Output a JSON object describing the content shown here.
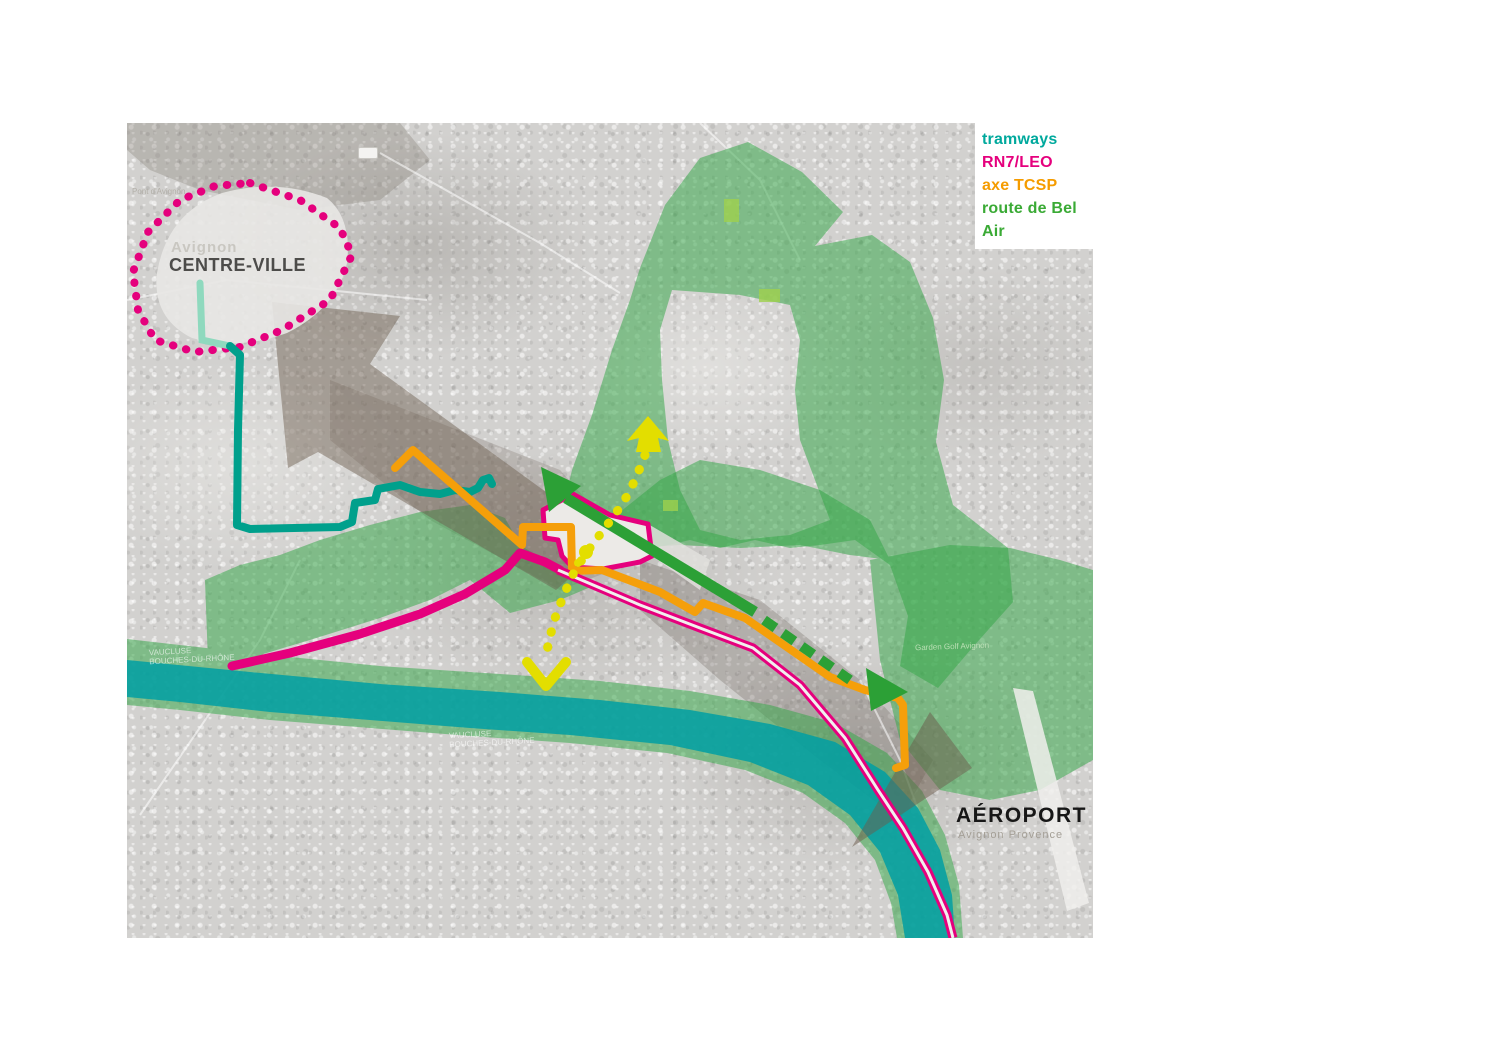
{
  "legend": {
    "items": [
      {
        "label": "tramways",
        "color": "#00A99D"
      },
      {
        "label": "RN7/LEO",
        "color": "#E5007D"
      },
      {
        "label": "axe TCSP",
        "color": "#F59C00"
      },
      {
        "label": "route de Bel Air",
        "color": "#3AAA35"
      }
    ]
  },
  "labels": {
    "city_faint": "Avignon",
    "centre_ville": "CENTRE-VILLE",
    "aeroport": "AÉROPORT",
    "aeroport_sub": "Avignon Provence",
    "pont": "Pont d'Avignon",
    "dept_a": "VAUCLUSE",
    "dept_b": "BOUCHES-DU-RHÔNE",
    "golf": "Garden Golf Avignon"
  },
  "features": {
    "routes": [
      {
        "name": "tramways",
        "color": "#00A99D"
      },
      {
        "name": "RN7/LEO",
        "color": "#E5007D"
      },
      {
        "name": "axe TCSP",
        "color": "#F59C00"
      },
      {
        "name": "route de Bel Air",
        "color": "#3AAA35"
      }
    ],
    "river_color": "#009FA3",
    "green_zone_color": "#33A646",
    "flow_arrow_color": "#6B5C4C",
    "study_axis_color": "#E3DE00",
    "centre_ville_boundary_color": "#E5007D",
    "project_zone_outline": "#E5007D"
  }
}
